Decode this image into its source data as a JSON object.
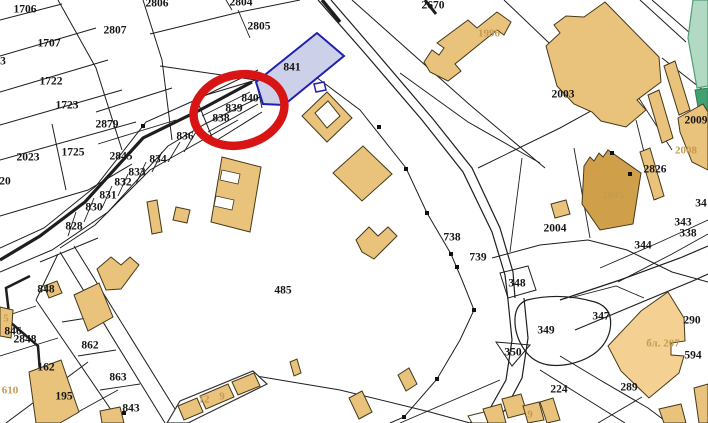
{
  "map": {
    "title": "cadastral-map",
    "background": "#ffffff",
    "colors": {
      "parcel_line": "#1e1e1e",
      "building_fill": "#e9c27c",
      "building_dark_fill": "#cfa049",
      "building_light_fill": "#f4d092",
      "building_stroke": "#45391a",
      "green_parcel_fill": "#b2d9c4",
      "green_parcel_dark_fill": "#43a171",
      "highlight_fill": "#ccd0e8",
      "highlight_stroke": "#2020b0",
      "annotation_red": "#d81414",
      "label_color": "#161616",
      "building_label_color": "#c49a50"
    },
    "highlight": {
      "parcel": "841",
      "shape": "polygon"
    },
    "annotation": {
      "type": "red-circle",
      "around_parcels": [
        "840",
        "839",
        "838"
      ]
    },
    "parcel_labels": [
      {
        "text": "1706",
        "x": 25,
        "y": 10
      },
      {
        "text": "2806",
        "x": 157,
        "y": 4
      },
      {
        "text": "2804",
        "x": 241,
        "y": 3
      },
      {
        "text": "2805",
        "x": 259,
        "y": 27
      },
      {
        "text": "2670",
        "x": 433,
        "y": 6
      },
      {
        "text": "2807",
        "x": 115,
        "y": 31
      },
      {
        "text": "1707",
        "x": 49,
        "y": 44
      },
      {
        "text": "3",
        "x": 3,
        "y": 62
      },
      {
        "text": "841",
        "x": 292,
        "y": 68
      },
      {
        "text": "1722",
        "x": 51,
        "y": 82
      },
      {
        "text": "2003",
        "x": 563,
        "y": 95
      },
      {
        "text": "840",
        "x": 250,
        "y": 99
      },
      {
        "text": "1723",
        "x": 67,
        "y": 106
      },
      {
        "text": "839",
        "x": 234,
        "y": 109
      },
      {
        "text": "838",
        "x": 221,
        "y": 119
      },
      {
        "text": "2879",
        "x": 107,
        "y": 125
      },
      {
        "text": "2009",
        "x": 696,
        "y": 121
      },
      {
        "text": "836",
        "x": 185,
        "y": 137
      },
      {
        "text": "1725",
        "x": 73,
        "y": 153
      },
      {
        "text": "2023",
        "x": 28,
        "y": 158
      },
      {
        "text": "2845",
        "x": 121,
        "y": 157
      },
      {
        "text": "834",
        "x": 158,
        "y": 160
      },
      {
        "text": "2826",
        "x": 655,
        "y": 170
      },
      {
        "text": "833",
        "x": 137,
        "y": 173
      },
      {
        "text": "832",
        "x": 123,
        "y": 183
      },
      {
        "text": "20",
        "x": 5,
        "y": 182
      },
      {
        "text": "831",
        "x": 108,
        "y": 196
      },
      {
        "text": "830",
        "x": 94,
        "y": 208
      },
      {
        "text": "34",
        "x": 701,
        "y": 204
      },
      {
        "text": "2004",
        "x": 555,
        "y": 229
      },
      {
        "text": "343",
        "x": 683,
        "y": 223
      },
      {
        "text": "828",
        "x": 74,
        "y": 227
      },
      {
        "text": "338",
        "x": 688,
        "y": 234
      },
      {
        "text": "738",
        "x": 452,
        "y": 238
      },
      {
        "text": "344",
        "x": 643,
        "y": 246
      },
      {
        "text": "739",
        "x": 478,
        "y": 258
      },
      {
        "text": "348",
        "x": 517,
        "y": 284
      },
      {
        "text": "485",
        "x": 283,
        "y": 291
      },
      {
        "text": "848",
        "x": 46,
        "y": 290
      },
      {
        "text": "349",
        "x": 546,
        "y": 331
      },
      {
        "text": "350",
        "x": 513,
        "y": 353
      },
      {
        "text": "846",
        "x": 13,
        "y": 332
      },
      {
        "text": "2848",
        "x": 25,
        "y": 340
      },
      {
        "text": "862",
        "x": 90,
        "y": 346
      },
      {
        "text": "347",
        "x": 601,
        "y": 317
      },
      {
        "text": "290",
        "x": 692,
        "y": 321
      },
      {
        "text": "162",
        "x": 46,
        "y": 368
      },
      {
        "text": "594",
        "x": 693,
        "y": 356
      },
      {
        "text": "863",
        "x": 118,
        "y": 378
      },
      {
        "text": "224",
        "x": 559,
        "y": 390
      },
      {
        "text": "289",
        "x": 629,
        "y": 388
      },
      {
        "text": "195",
        "x": 64,
        "y": 397
      },
      {
        "text": "843",
        "x": 131,
        "y": 409
      }
    ],
    "building_labels": [
      {
        "text": "1996",
        "x": 489,
        "y": 34
      },
      {
        "text": "2008",
        "x": 686,
        "y": 151
      },
      {
        "text": "2005",
        "x": 613,
        "y": 196
      },
      {
        "text": "бл. 207",
        "x": 663,
        "y": 344
      },
      {
        "text": "5",
        "x": 6,
        "y": 319
      },
      {
        "text": "610",
        "x": 10,
        "y": 391
      },
      {
        "text": "12",
        "x": 204,
        "y": 400
      },
      {
        "text": "9",
        "x": 222,
        "y": 397
      },
      {
        "text": "9",
        "x": 530,
        "y": 415
      }
    ]
  }
}
